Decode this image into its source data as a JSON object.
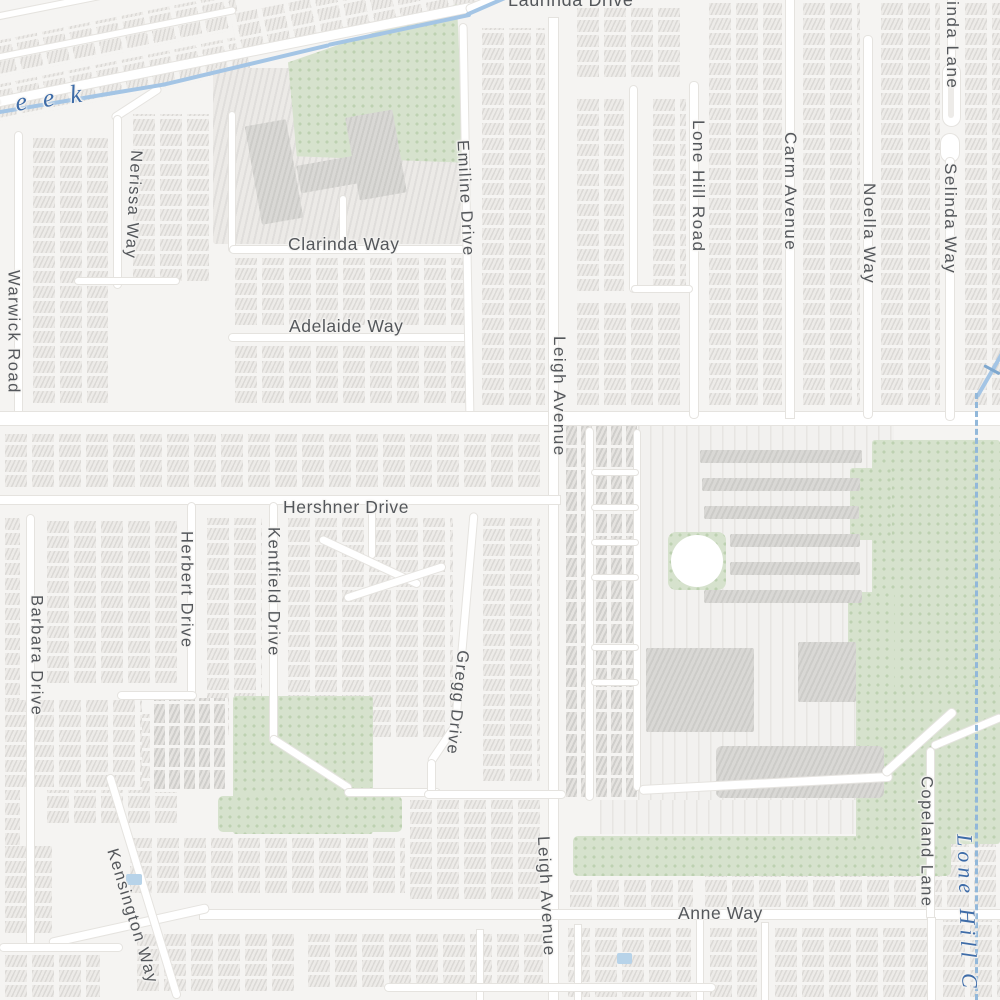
{
  "map": {
    "type": "street-map",
    "background_color": "#f5f4f2",
    "road_color": "#ffffff",
    "park_color": "#d6e2cd",
    "water_color": "#a4c5e5",
    "boundary_dash_color": "#92b8da",
    "street_label_color": "#54575b",
    "water_label_color": "#3e6ca8"
  },
  "streets": {
    "laurinda": "Laurinda Drive",
    "warwick": "Warwick Road",
    "nerissa": "Nerissa Way",
    "clarinda_way": "Clarinda Way",
    "adelaide": "Adelaide Way",
    "emiline": "Emiline Drive",
    "leigh_north": "Leigh Avenue",
    "leigh_south": "Leigh Avenue",
    "lone_hill_road": "Lone Hill Road",
    "carm": "Carm Avenue",
    "noella": "Noella Way",
    "selinda": "Selinda Way",
    "clarinda_lane": "Clarinda Lane",
    "hershner": "Hershner Drive",
    "herbert": "Herbert Drive",
    "kentfield": "Kentfield Drive",
    "gregg": "Gregg Drive",
    "barbara": "Barbara Drive",
    "kensington": "Kensington Way",
    "copeland": "Copeland Lane",
    "anne": "Anne Way"
  },
  "waterways": {
    "creek_label_partial": "reek",
    "lone_hill_creek_partial": "Lone Hill C"
  }
}
